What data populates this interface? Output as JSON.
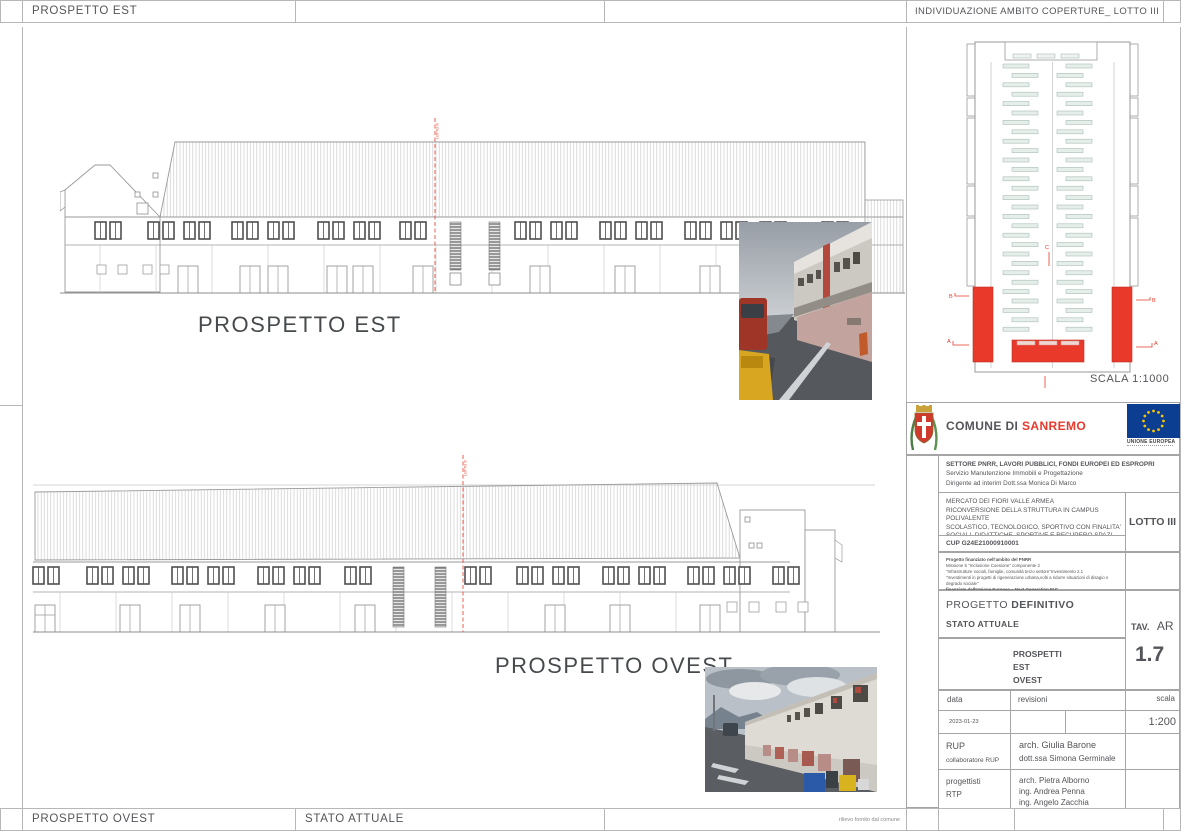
{
  "sheet": {
    "top_bar": {
      "left_label": "PROSPETTO EST",
      "right_label": "INDIVIDUAZIONE AMBITO COPERTURE_ LOTTO III"
    },
    "bottom_bar": {
      "left_label": "PROSPETTO OVEST",
      "center_label": "STATO ATTUALE",
      "note": "rilievo fornito dal comune"
    }
  },
  "elevations": {
    "est": {
      "caption": "PROSPETTO EST",
      "lot_line_label": "LOTTO III"
    },
    "ovest": {
      "caption": "PROSPETTO OVEST",
      "lot_line_label": "LOTTO III"
    }
  },
  "plan": {
    "scale_label": "SCALA 1:1000",
    "marker_a": "A",
    "marker_b": "B",
    "marker_c": "C"
  },
  "title_block": {
    "municipality_prefix": "COMUNE DI ",
    "municipality_name": "SANREMO",
    "eu_label": "UNIONE EUROPEA",
    "department_lines": [
      "SETTORE  PNRR, LAVORI PUBBLICI, FONDI EUROPEI ED ESPROPRI",
      "Servizio Manutenzione Immobili e Progettazione",
      "Dirigente ad interim Dott.ssa Monica Di Marco"
    ],
    "project_lines": [
      "MERCATO DEI FIORI VALLE ARMEA",
      "RICONVERSIONE DELLA STRUTTURA IN CAMPUS POLIVALENTE",
      "SCOLASTICO, TECNOLOGICO, SPORTIVO CON FINALITA'",
      "SOCIALI, DIDATTICHE, SPORTIVE E RECUPERO SPAZI ESTERNI"
    ],
    "lotto": "LOTTO III",
    "cup": "CUP G24E21000910001",
    "funding_lines": [
      "Progetto finanziato nell'ambito del PNRR",
      "Missione 5 \"Inclusione Coesione\" componente 2",
      "\"Infrastrutture sociali, famiglie, comunità terzo settore\"Investimento 2.1",
      "\"Investimenti in progetti di rigenerazione urbana,volti a ridurre situazioni di disagio e degrado sociale\"",
      "finanziato dall'Unione Europea – Next Generation EU\""
    ],
    "phase_prefix": "PROGETTO ",
    "phase_name": "DEFINITIVO",
    "status": "STATO ATTUALE",
    "tav_label": "TAV.",
    "tav_code": "AR",
    "sheet_title_lines": [
      "PROSPETTI",
      "EST",
      "OVEST"
    ],
    "sheet_number": "1.7",
    "data_label": "data",
    "revisioni_label": "revisioni",
    "scala_label": "scala",
    "date_value": "2023-01-23",
    "scale_value": "1:200",
    "rup_label": "RUP",
    "rup_collab_label": "collaboratore RUP",
    "rup_name": "arch. Giulia Barone",
    "rup_collab_name": "dott.ssa Simona Germinale",
    "designers_label1": "progettisti",
    "designers_label2": "RTP",
    "designers": [
      "arch. Pietra Alborno",
      "ing. Andrea Penna",
      "ing. Angelo Zacchia"
    ]
  },
  "colors": {
    "accent_red": "#e8392b",
    "eu_blue": "#0b3d91",
    "eu_star": "#f7c408",
    "line_gray": "#9a9a9a",
    "text_gray": "#55565a"
  }
}
